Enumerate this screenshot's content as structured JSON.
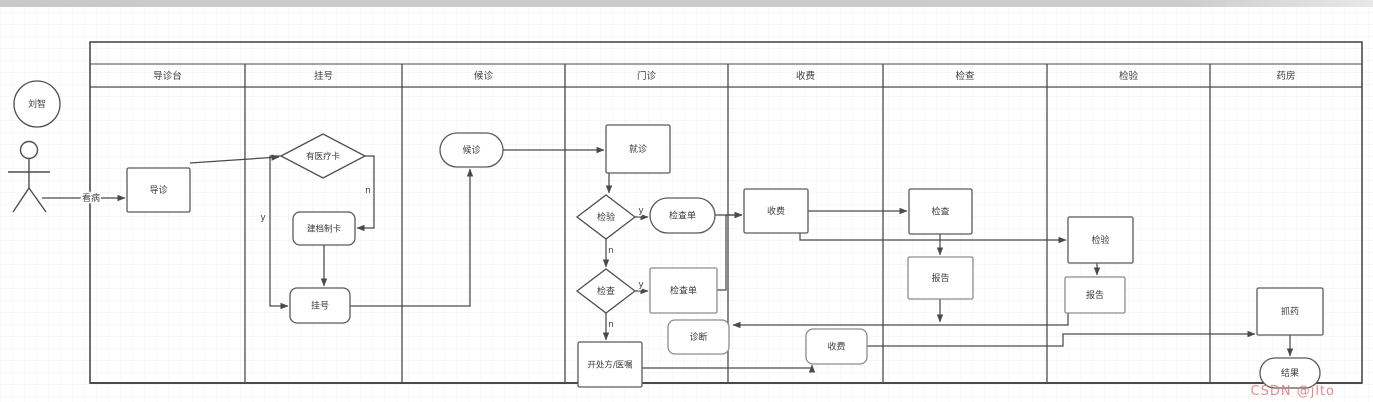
{
  "watermark": {
    "text": "CSDN @jlto",
    "color": "#de7680"
  },
  "actor": {
    "name": "刘智",
    "cx": 37,
    "cy": 104,
    "r": 23
  },
  "start_edge_label": "看病",
  "pool": {
    "x": 90,
    "y": 42,
    "w": 1272,
    "h": 341,
    "title": "",
    "title_bottom_y": 64,
    "header_bottom_y": 87
  },
  "lanes": [
    {
      "id": "guide-desk",
      "label": "导诊台",
      "x0": 90,
      "x1": 245
    },
    {
      "id": "registration",
      "label": "挂号",
      "x0": 245,
      "x1": 402
    },
    {
      "id": "waiting",
      "label": "候诊",
      "x0": 402,
      "x1": 565
    },
    {
      "id": "outpatient",
      "label": "门诊",
      "x0": 565,
      "x1": 728
    },
    {
      "id": "payment",
      "label": "收费",
      "x0": 728,
      "x1": 883
    },
    {
      "id": "examination",
      "label": "检查",
      "x0": 883,
      "x1": 1047
    },
    {
      "id": "lab-test",
      "label": "检验",
      "x0": 1047,
      "x1": 1210
    },
    {
      "id": "pharmacy",
      "label": "药房",
      "x0": 1210,
      "x1": 1362
    }
  ],
  "nodes": [
    {
      "id": "guide-task",
      "shape": "rect",
      "label": "导诊",
      "x": 127,
      "y": 168,
      "w": 63,
      "h": 44
    },
    {
      "id": "has-medical-card-decision",
      "shape": "diamond",
      "label": "有医疗卡",
      "x": 281,
      "y": 134,
      "w": 84,
      "h": 44,
      "small": true
    },
    {
      "id": "create-card-task",
      "shape": "round",
      "label": "建档制卡",
      "x": 293,
      "y": 212,
      "w": 62,
      "h": 33,
      "small": true
    },
    {
      "id": "register-task",
      "shape": "round",
      "label": "挂号",
      "x": 290,
      "y": 288,
      "w": 60,
      "h": 35
    },
    {
      "id": "wait-task",
      "shape": "stadium",
      "label": "候诊",
      "x": 440,
      "y": 133,
      "w": 63,
      "h": 34
    },
    {
      "id": "consult-task",
      "shape": "rect",
      "label": "就诊",
      "x": 606,
      "y": 125,
      "w": 64,
      "h": 48
    },
    {
      "id": "lab-test-decision",
      "shape": "diamond",
      "label": "检验",
      "x": 577,
      "y": 195,
      "w": 58,
      "h": 44
    },
    {
      "id": "test-order-stadium",
      "shape": "stadium",
      "label": "检查单",
      "x": 650,
      "y": 198,
      "w": 65,
      "h": 35
    },
    {
      "id": "exam-decision",
      "shape": "diamond",
      "label": "检查",
      "x": 577,
      "y": 269,
      "w": 58,
      "h": 44
    },
    {
      "id": "exam-order-task",
      "shape": "rect",
      "label": "检查单",
      "x": 650,
      "y": 268,
      "w": 67,
      "h": 45,
      "muted": true
    },
    {
      "id": "diagnosis-task",
      "shape": "round",
      "label": "诊断",
      "x": 668,
      "y": 320,
      "w": 61,
      "h": 34,
      "muted": true
    },
    {
      "id": "prescription-task",
      "shape": "rect",
      "label": "开处方/医嘱",
      "x": 578,
      "y": 342,
      "w": 64,
      "h": 45,
      "small": true
    },
    {
      "id": "payment-task-1",
      "shape": "rect",
      "label": "收费",
      "x": 744,
      "y": 189,
      "w": 64,
      "h": 44
    },
    {
      "id": "exam-task",
      "shape": "rect",
      "label": "检查",
      "x": 909,
      "y": 189,
      "w": 63,
      "h": 45
    },
    {
      "id": "report-task-1",
      "shape": "rect",
      "label": "报告",
      "x": 908,
      "y": 257,
      "w": 65,
      "h": 42,
      "muted": true
    },
    {
      "id": "lab-test-task",
      "shape": "rect",
      "label": "检验",
      "x": 1068,
      "y": 217,
      "w": 65,
      "h": 46
    },
    {
      "id": "report-task-2",
      "shape": "rect",
      "label": "报告",
      "x": 1065,
      "y": 277,
      "w": 60,
      "h": 36,
      "muted": true
    },
    {
      "id": "dispense-task",
      "shape": "rect",
      "label": "抓药",
      "x": 1257,
      "y": 288,
      "w": 66,
      "h": 47
    },
    {
      "id": "payment-task-2",
      "shape": "round",
      "label": "收费",
      "x": 806,
      "y": 329,
      "w": 61,
      "h": 35,
      "muted": true
    },
    {
      "id": "result-end",
      "shape": "stadium",
      "label": "结果",
      "x": 1260,
      "y": 358,
      "w": 60,
      "h": 30
    }
  ],
  "edges": [
    {
      "id": "see-doctor",
      "pts": [
        [
          42,
          198
        ],
        [
          125,
          198
        ]
      ],
      "label": "看病",
      "lx": 91,
      "ly": 201
    },
    {
      "id": "guide-to-card",
      "pts": [
        [
          190,
          163
        ],
        [
          279,
          157
        ]
      ]
    },
    {
      "id": "card-no",
      "pts": [
        [
          365,
          156
        ],
        [
          374,
          156
        ],
        [
          374,
          228
        ],
        [
          357,
          228
        ]
      ],
      "label": "n",
      "lx": 368,
      "ly": 193
    },
    {
      "id": "card-yes",
      "pts": [
        [
          281,
          156
        ],
        [
          270,
          156
        ],
        [
          270,
          306
        ],
        [
          288,
          306
        ]
      ],
      "label": "y",
      "lx": 263,
      "ly": 220
    },
    {
      "id": "card-to-register",
      "pts": [
        [
          324,
          245
        ],
        [
          324,
          286
        ]
      ]
    },
    {
      "id": "register-to-wait",
      "pts": [
        [
          350,
          306
        ],
        [
          470,
          306
        ],
        [
          470,
          169
        ]
      ]
    },
    {
      "id": "wait-to-consult",
      "pts": [
        [
          503,
          150
        ],
        [
          604,
          150
        ]
      ]
    },
    {
      "id": "consult-to-labtest",
      "pts": [
        [
          609,
          173
        ],
        [
          609,
          193
        ]
      ]
    },
    {
      "id": "labtest-yes",
      "pts": [
        [
          635,
          217
        ],
        [
          648,
          217
        ]
      ],
      "label": "y",
      "lx": 641,
      "ly": 213
    },
    {
      "id": "labtest-no",
      "pts": [
        [
          606,
          239
        ],
        [
          606,
          267
        ]
      ],
      "label": "n",
      "lx": 611,
      "ly": 253
    },
    {
      "id": "exam-yes",
      "pts": [
        [
          635,
          291
        ],
        [
          648,
          291
        ]
      ],
      "label": "y",
      "lx": 641,
      "ly": 287
    },
    {
      "id": "exam-no",
      "pts": [
        [
          606,
          313
        ],
        [
          606,
          340
        ]
      ],
      "label": "n",
      "lx": 611,
      "ly": 327
    },
    {
      "id": "order1-to-payment",
      "pts": [
        [
          715,
          215
        ],
        [
          742,
          215
        ]
      ]
    },
    {
      "id": "order2-to-payment",
      "pts": [
        [
          717,
          290
        ],
        [
          726,
          290
        ],
        [
          726,
          215
        ],
        [
          742,
          215
        ]
      ]
    },
    {
      "id": "payment-to-exam",
      "pts": [
        [
          808,
          211
        ],
        [
          907,
          211
        ]
      ]
    },
    {
      "id": "payment-to-labtest",
      "pts": [
        [
          800,
          233
        ],
        [
          800,
          240
        ],
        [
          1066,
          240
        ]
      ]
    },
    {
      "id": "exam-to-report1",
      "pts": [
        [
          940,
          234
        ],
        [
          940,
          255
        ]
      ]
    },
    {
      "id": "report1-to-diagnosis",
      "pts": [
        [
          940,
          299
        ],
        [
          940,
          322
        ]
      ]
    },
    {
      "id": "labtest-to-report2",
      "pts": [
        [
          1097,
          263
        ],
        [
          1097,
          275
        ]
      ]
    },
    {
      "id": "report2-to-diagnosis",
      "pts": [
        [
          1068,
          313
        ],
        [
          1068,
          325
        ],
        [
          733,
          325
        ]
      ]
    },
    {
      "id": "prescription-to-pay2",
      "pts": [
        [
          642,
          368
        ],
        [
          812,
          368
        ],
        [
          812,
          365
        ]
      ]
    },
    {
      "id": "pay2-to-dispense",
      "pts": [
        [
          867,
          346
        ],
        [
          1063,
          346
        ],
        [
          1063,
          334
        ],
        [
          1255,
          334
        ]
      ]
    },
    {
      "id": "dispense-to-result",
      "pts": [
        [
          1290,
          335
        ],
        [
          1290,
          356
        ]
      ]
    }
  ],
  "colors": {
    "line": "#4a4a4a",
    "muted_border": "#8d8d8d",
    "node_fill": "#ffffff"
  }
}
